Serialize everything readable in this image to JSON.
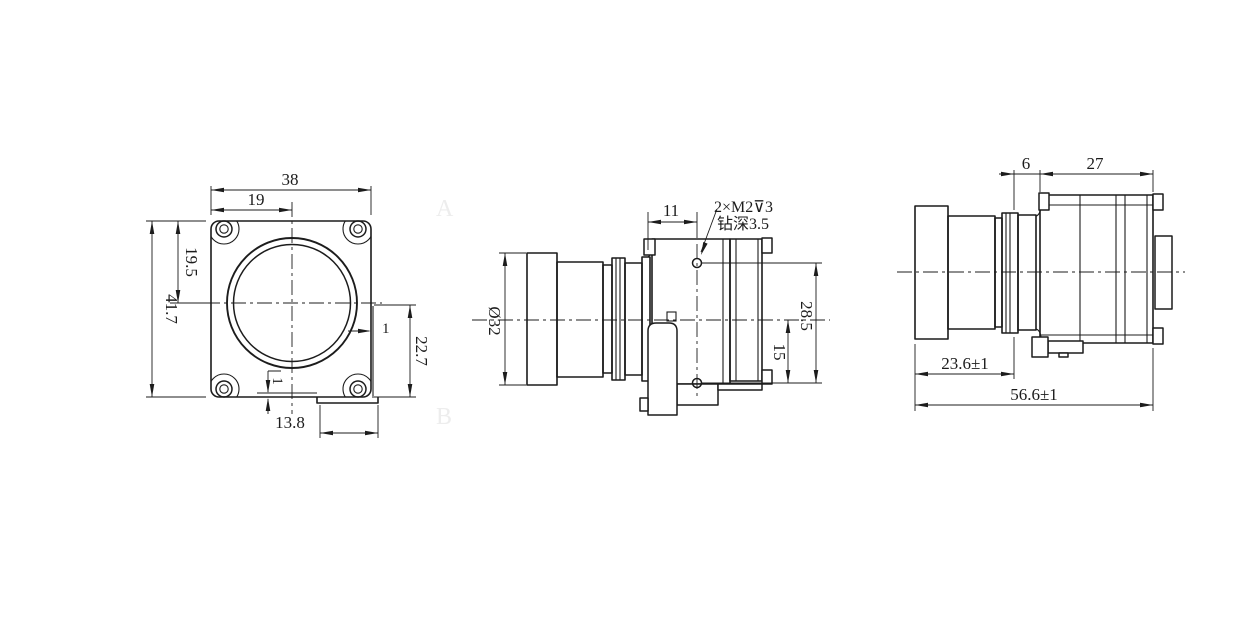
{
  "title": "camera lens assembly engineering drawing",
  "colors": {
    "background": "#ffffff",
    "line": "#1c1c1c",
    "zone_marker": "#ededed"
  },
  "front_view": {
    "dim_width": "38",
    "dim_width_half": "19",
    "dim_height": "41.7",
    "dim_height_half": "19.5",
    "dim_step_height": "22.7",
    "dim_step_right": "1",
    "dim_step_bottom": "1",
    "dim_slot_width": "13.8"
  },
  "side_view": {
    "dim_lens_diameter": "Ø32",
    "dim_hole_offset": "11",
    "dim_hole_span": "28.5",
    "dim_hole_to_center": "15",
    "note_thread": "2×M2⊽3",
    "note_drill_depth": "钻深3.5"
  },
  "rear_view": {
    "dim_neck": "6",
    "dim_body_length": "27",
    "dim_lens_length": "23.6±1",
    "dim_overall_length": "56.6±1"
  },
  "zone_markers": {
    "a": "A",
    "b": "B"
  }
}
